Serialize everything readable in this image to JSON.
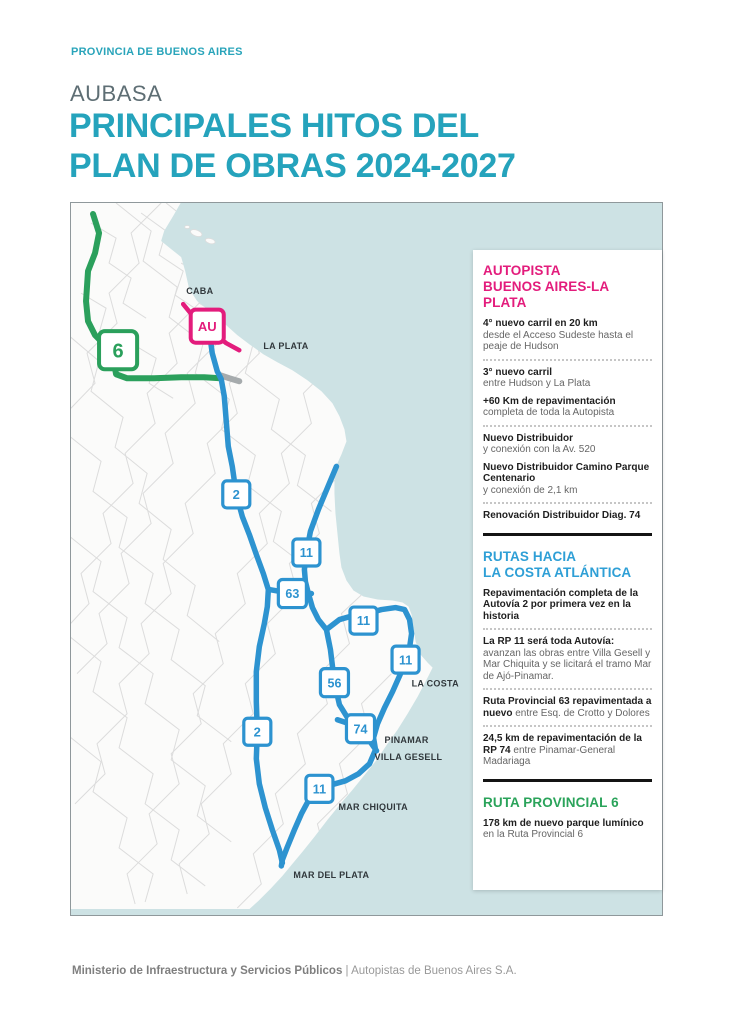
{
  "page": {
    "kicker": "PROVINCIA DE BUENOS AIRES",
    "brand": "AUBASA",
    "title_line1": "PRINCIPALES HITOS DEL",
    "title_line2": "PLAN DE OBRAS 2024-2027"
  },
  "footer": {
    "bold": "Ministerio de Infraestructura y Servicios Públicos",
    "rest": "| Autopistas de Buenos Aires S.A."
  },
  "colors": {
    "heading_teal": "#25a3bc",
    "kicker_teal": "#29a4ba",
    "pink": "#e31c7c",
    "blue": "#2e9fd6",
    "route_blue": "#2d93d0",
    "green": "#2aa35a",
    "route_green": "#2ba05c",
    "water": "#cde2e4",
    "gray_route": "#a6abad",
    "map_label": "#31383c"
  },
  "map": {
    "labels": [
      {
        "text": "CABA",
        "x": 115,
        "y": 91
      },
      {
        "text": "LA PLATA",
        "x": 192,
        "y": 146
      },
      {
        "text": "LA COSTA",
        "x": 340,
        "y": 483
      },
      {
        "text": "PINAMAR",
        "x": 313,
        "y": 539
      },
      {
        "text": "VILLA GESELL",
        "x": 303,
        "y": 556
      },
      {
        "text": "MAR CHIQUITA",
        "x": 267,
        "y": 606
      },
      {
        "text": "MAR DEL PLATA",
        "x": 222,
        "y": 674
      }
    ],
    "shields": [
      {
        "label": "6",
        "x": 47,
        "y": 147,
        "color": "#2ba05c",
        "size": 38,
        "font": 20
      },
      {
        "label": "AU",
        "x": 136,
        "y": 123,
        "color": "#e31c7c",
        "size": 33,
        "font": 13
      },
      {
        "label": "2",
        "x": 165,
        "y": 291,
        "color": "#2d93d0",
        "size": 27,
        "font": 13
      },
      {
        "label": "11",
        "x": 235,
        "y": 349,
        "color": "#2d93d0",
        "size": 27,
        "font": 12.5
      },
      {
        "label": "63",
        "x": 221,
        "y": 390,
        "color": "#2d93d0",
        "size": 28,
        "font": 12.5
      },
      {
        "label": "11",
        "x": 292,
        "y": 417,
        "color": "#2d93d0",
        "size": 27,
        "font": 12.5
      },
      {
        "label": "11",
        "x": 334,
        "y": 456,
        "color": "#2d93d0",
        "size": 27,
        "font": 12.5
      },
      {
        "label": "56",
        "x": 263,
        "y": 479,
        "color": "#2d93d0",
        "size": 28,
        "font": 12.5
      },
      {
        "label": "74",
        "x": 289,
        "y": 525,
        "color": "#2d93d0",
        "size": 28,
        "font": 12.5
      },
      {
        "label": "2",
        "x": 186,
        "y": 528,
        "color": "#2d93d0",
        "size": 27,
        "font": 13
      },
      {
        "label": "11",
        "x": 248,
        "y": 585,
        "color": "#2d93d0",
        "size": 27,
        "font": 12.5
      }
    ]
  },
  "panel": {
    "sections": [
      {
        "title_lines": [
          "AUTOPISTA",
          "BUENOS AIRES-LA PLATA"
        ],
        "color": "#e31c7c",
        "items": [
          {
            "bold": "4° nuevo carril en 20 km",
            "text": "desde el Acceso Sudeste hasta el peaje de Hudson",
            "bold_block": true,
            "sep_after": true
          },
          {
            "bold": "3° nuevo carril",
            "text": "entre Hudson y La Plata",
            "bold_block": true,
            "sep_after": false
          },
          {
            "bold": "+60 Km de repavimentación",
            "text": "completa de toda la Autopista",
            "bold_block": true,
            "sep_after": true
          },
          {
            "bold": "Nuevo Distribuidor",
            "text": "y conexión con la Av. 520",
            "bold_block": true,
            "sep_after": false
          },
          {
            "bold": "Nuevo Distribuidor Camino Parque Centenario",
            "text": "y conexión de 2,1 km",
            "bold_block": true,
            "sep_after": true
          },
          {
            "bold": "Renovación Distribuidor Diag. 74",
            "text": "",
            "bold_block": true,
            "sep_after": false
          }
        ]
      },
      {
        "title_lines": [
          "RUTAS HACIA",
          "LA COSTA ATLÁNTICA"
        ],
        "color": "#2e9fd6",
        "items": [
          {
            "bold": "Repavimentación completa de la Autovía 2 por primera vez en la historia",
            "text": "",
            "bold_block": true,
            "sep_after": true
          },
          {
            "bold": "La RP 11 será toda Autovía:",
            "text": "avanzan las obras entre Villa Gesell y Mar Chiquita y se licitará el tramo Mar de Ajó-Pinamar.",
            "bold_block": true,
            "sep_after": true
          },
          {
            "bold": "Ruta Provincial 63 repavimentada a nuevo",
            "text": "entre Esq. de Crotto y Dolores",
            "bold_block": false,
            "sep_after": true
          },
          {
            "bold": "24,5 km de repavimentación de la RP 74",
            "text": "entre Pinamar-General Madariaga",
            "bold_block": false,
            "sep_after": false
          }
        ]
      },
      {
        "title_lines": [
          "RUTA PROVINCIAL 6"
        ],
        "color": "#2aa35a",
        "items": [
          {
            "bold": "178 km de nuevo parque lumínico",
            "text": "en la Ruta Provincial 6",
            "bold_block": true,
            "sep_after": false
          }
        ]
      }
    ]
  }
}
